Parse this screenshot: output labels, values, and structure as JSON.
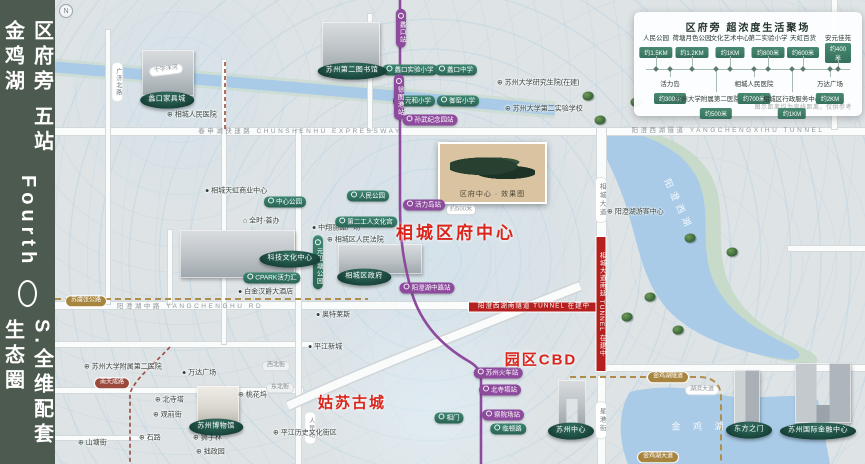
{
  "sidebar": {
    "top": "区府旁 五站金鸡湖",
    "latin": "Fourth",
    "bottom": "S.全维配套生态圈"
  },
  "compass": "N",
  "legend": {
    "title": "区府旁 超浓度生活聚场",
    "note": "图示距离均为直线距离，仅供参考",
    "top_items": [
      {
        "name": "人民公园",
        "dist": "约1.5KM"
      },
      {
        "name": "荷塘月色公园",
        "dist": "约1.2KM"
      },
      {
        "name": "文化艺术中心",
        "dist": "约1KM"
      },
      {
        "name": "第二实验小学",
        "dist": "约800米"
      },
      {
        "name": "天虹百货",
        "dist": "约600米"
      },
      {
        "name": "安元佳苑",
        "dist": "约400米"
      }
    ],
    "bottom_items": [
      {
        "name": "活力岛",
        "dist": "约300米"
      },
      {
        "name": "苏州大学附属第二医院(在建)",
        "dist": "约500米"
      },
      {
        "name": "相城人民医院",
        "dist": "约700米"
      },
      {
        "name": "相城区行政服务中心",
        "dist": "约1KM"
      },
      {
        "name": "万达广场",
        "dist": "约2KM"
      }
    ]
  },
  "project": {
    "caption": "区府中心 · 效果图"
  },
  "map_labels": [
    {
      "type": "vstation",
      "text": "蠡口站",
      "x": 401,
      "y": 28
    },
    {
      "type": "vstation",
      "text": "徐图港站",
      "x": 399,
      "y": 97
    },
    {
      "type": "station",
      "text": "孙武纪念园站",
      "x": 430,
      "y": 120
    },
    {
      "type": "station",
      "text": "活力岛站",
      "x": 424,
      "y": 205
    },
    {
      "type": "dist",
      "text": "约500米",
      "x": 461,
      "y": 210
    },
    {
      "type": "station",
      "text": "阳澄湖中路站",
      "x": 427,
      "y": 288
    },
    {
      "type": "station",
      "text": "苏州火车站",
      "x": 498,
      "y": 373
    },
    {
      "type": "station",
      "text": "北寺塔站",
      "x": 500,
      "y": 390
    },
    {
      "type": "station",
      "text": "察院场站",
      "x": 503,
      "y": 415
    },
    {
      "type": "gpill",
      "text": "中心公园",
      "x": 285,
      "y": 202
    },
    {
      "type": "gpill",
      "text": "人民公园",
      "x": 368,
      "y": 196
    },
    {
      "type": "gpill",
      "text": "第二工人文化宫",
      "x": 366,
      "y": 222
    },
    {
      "type": "gpill",
      "text": "CPARK活力汇",
      "x": 272,
      "y": 278
    },
    {
      "type": "vgpill",
      "text": "元和塘公园",
      "x": 318,
      "y": 262
    },
    {
      "type": "gpill",
      "text": "蠡口实验小学",
      "x": 410,
      "y": 70
    },
    {
      "type": "gpill",
      "text": "蠡口中学",
      "x": 456,
      "y": 70
    },
    {
      "type": "gpill",
      "text": "元和小学",
      "x": 414,
      "y": 101
    },
    {
      "type": "gpill",
      "text": "御窑小学",
      "x": 458,
      "y": 101
    },
    {
      "type": "gpill",
      "text": "相门",
      "x": 449,
      "y": 418
    },
    {
      "type": "gpill",
      "text": "临顿路",
      "x": 508,
      "y": 429
    },
    {
      "type": "ellipse",
      "text": "蠡口家具城",
      "x": 167,
      "y": 100
    },
    {
      "type": "ellipse",
      "text": "苏州第二图书馆",
      "x": 352,
      "y": 71
    },
    {
      "type": "ellipse",
      "text": "科技文化中心",
      "x": 290,
      "y": 259
    },
    {
      "type": "ellipse",
      "text": "相城区政府",
      "x": 364,
      "y": 277
    },
    {
      "type": "ellipse",
      "text": "苏州博物馆",
      "x": 216,
      "y": 427
    },
    {
      "type": "ellipse",
      "text": "苏州中心",
      "x": 571,
      "y": 431
    },
    {
      "type": "ellipse",
      "text": "东方之门",
      "x": 749,
      "y": 430
    },
    {
      "type": "ellipse",
      "text": "苏州国际金融中心",
      "x": 818,
      "y": 431
    },
    {
      "type": "dot",
      "text": "● 相城天虹商业中心",
      "x": 205,
      "y": 192
    },
    {
      "type": "dot",
      "text": "⌂ 全时·荟办",
      "x": 243,
      "y": 222
    },
    {
      "type": "dot",
      "text": "● 中翔丽晶广场",
      "x": 312,
      "y": 229
    },
    {
      "type": "dot",
      "text": "⊕ 相城区人民法院",
      "x": 327,
      "y": 241
    },
    {
      "type": "dot",
      "text": "● 白金汉爵大酒店",
      "x": 238,
      "y": 293
    },
    {
      "type": "dot",
      "text": "⊕ 相城人民医院",
      "x": 167,
      "y": 116
    },
    {
      "type": "dot",
      "text": "⊕ 苏州大学研究生院(在建)",
      "x": 497,
      "y": 84
    },
    {
      "type": "dot",
      "text": "⊕ 苏州大学第二实验学校",
      "x": 505,
      "y": 110
    },
    {
      "type": "dot",
      "text": "⊕ 阳澄湖游客中心",
      "x": 607,
      "y": 213
    },
    {
      "type": "dot",
      "text": "⊕ 苏州大学附属第二医院",
      "x": 84,
      "y": 368
    },
    {
      "type": "dot",
      "text": "● 万达广场",
      "x": 182,
      "y": 374
    },
    {
      "type": "dot",
      "text": "● 平江新城",
      "x": 308,
      "y": 348
    },
    {
      "type": "dot",
      "text": "● 奥特莱斯",
      "x": 316,
      "y": 316
    },
    {
      "type": "dot",
      "text": "⊕ 北寺塔",
      "x": 155,
      "y": 401
    },
    {
      "type": "dot",
      "text": "⊕ 观前街",
      "x": 153,
      "y": 416
    },
    {
      "type": "dot",
      "text": "⊕ 石路",
      "x": 139,
      "y": 439
    },
    {
      "type": "dot",
      "text": "⊕ 狮子林",
      "x": 193,
      "y": 439
    },
    {
      "type": "dot",
      "text": "⊕ 拙政园",
      "x": 196,
      "y": 453
    },
    {
      "type": "dot",
      "text": "⊕ 桃花坞",
      "x": 238,
      "y": 396
    },
    {
      "type": "dot",
      "text": "⊕ 平江历史文化街区",
      "x": 273,
      "y": 434
    },
    {
      "type": "dot",
      "text": "⊕ 山塘街",
      "x": 78,
      "y": 444
    },
    {
      "type": "roadtext",
      "text": "春申湖快速路 CHUNSHENHU EXPRESSWAY",
      "x": 300,
      "y": 132
    },
    {
      "type": "roadtext",
      "text": "阳澄西湖隧道 YANGCHENGXIHU TUNNEL",
      "x": 728,
      "y": 131
    },
    {
      "type": "roadtext",
      "text": "阳澄湖中路 YANGCHENGHU RD",
      "x": 190,
      "y": 307
    },
    {
      "type": "vroadpill",
      "text": "相城大道",
      "x": 601,
      "y": 200
    },
    {
      "type": "vroadpill",
      "text": "星港街",
      "x": 601,
      "y": 420
    },
    {
      "type": "vroadpill2",
      "text": "人民路",
      "x": 310,
      "y": 428
    },
    {
      "type": "vroadpill2",
      "text": "广济北路",
      "x": 117,
      "y": 82
    },
    {
      "type": "graypill",
      "text": "西北街",
      "x": 276,
      "y": 366
    },
    {
      "type": "graypill",
      "text": "东北街",
      "x": 280,
      "y": 388
    },
    {
      "type": "goldpill",
      "text": "苏虞张公路",
      "x": 86,
      "y": 301
    },
    {
      "type": "goldpill",
      "text": "金鸡湖隧道",
      "x": 668,
      "y": 377
    },
    {
      "type": "goldpill",
      "text": "金鸡湖大道",
      "x": 658,
      "y": 457
    },
    {
      "type": "whitepill",
      "text": "湖滨大道",
      "x": 702,
      "y": 390
    },
    {
      "type": "whitepill",
      "text": "十字洋河",
      "x": 166,
      "y": 70,
      "rot": -7
    },
    {
      "type": "maroonpill",
      "text": "南天成路",
      "x": 112,
      "y": 383
    },
    {
      "type": "bannerh",
      "text": "阳澄西湖南隧道 TUNNEL 在建中",
      "x": 534,
      "y": 307,
      "w": 132,
      "h": 11
    },
    {
      "type": "bannerv",
      "text": "相城大道南延 TUNNEL 在建中",
      "x": 601,
      "y": 304,
      "w": 11,
      "h": 136
    },
    {
      "type": "bigred",
      "text": "相城区府中心",
      "x": 456,
      "y": 233
    },
    {
      "type": "bigred2",
      "text": "姑苏古城",
      "x": 352,
      "y": 404
    },
    {
      "type": "bigred2",
      "text": "园区CBD",
      "x": 541,
      "y": 361
    },
    {
      "type": "waterlabel",
      "text": "阳澄西湖",
      "x": 678,
      "y": 205,
      "rot": 65
    },
    {
      "type": "waterlabel",
      "text": "金 鸡 湖",
      "x": 700,
      "y": 427
    }
  ],
  "trees": [
    [
      588,
      96
    ],
    [
      636,
      102
    ],
    [
      600,
      120
    ],
    [
      690,
      238
    ],
    [
      732,
      252
    ],
    [
      650,
      297
    ],
    [
      627,
      317
    ],
    [
      678,
      330
    ]
  ],
  "buildings": [
    {
      "x": 142,
      "y": 50,
      "w": 52,
      "h": 46,
      "kind": "city-cluster"
    },
    {
      "x": 322,
      "y": 22,
      "w": 58,
      "h": 50,
      "kind": "city-cluster"
    },
    {
      "x": 180,
      "y": 230,
      "w": 115,
      "h": 48,
      "kind": "culture-center"
    },
    {
      "x": 338,
      "y": 244,
      "w": 84,
      "h": 30,
      "kind": "government"
    },
    {
      "x": 197,
      "y": 386,
      "w": 42,
      "h": 38,
      "kind": "museum"
    },
    {
      "x": 558,
      "y": 380,
      "w": 28,
      "h": 45,
      "kind": "gate-arch"
    },
    {
      "x": 734,
      "y": 370,
      "w": 26,
      "h": 54,
      "kind": "tower"
    },
    {
      "x": 795,
      "y": 363,
      "w": 56,
      "h": 60,
      "kind": "twin-towers"
    }
  ],
  "colors": {
    "sidebar": "#4d5a4f",
    "metro_line": "#8e4b9e",
    "transit_green": "#2a6354",
    "highlight_red": "#d9251c",
    "construction_red": "#b5201f",
    "gold_route": "#b08d4a",
    "water": "#a9cbe7"
  }
}
